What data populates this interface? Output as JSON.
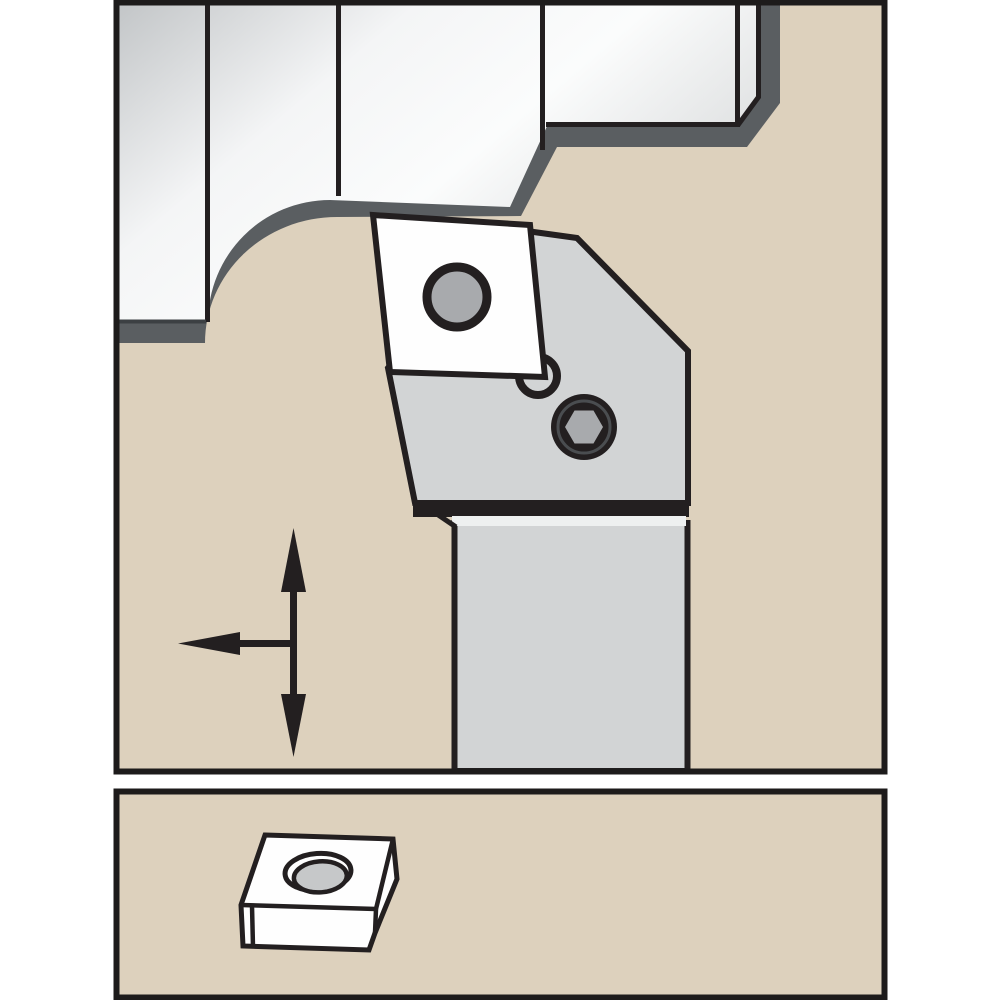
{
  "canvas": {
    "width": 1000,
    "height": 1000,
    "background": "#ffffff"
  },
  "colors": {
    "panel_background": "#ddd1bd",
    "panel_border": "#1d1b1b",
    "outline_black": "#231f20",
    "workpiece_contour_band": "#5a5e61",
    "silver_edge_dark": "#c2c5c7",
    "silver_bright": "#f4f5f6",
    "silver_highlight": "#fbfcfc",
    "silver_tail": "#d7d9da",
    "tool_body_gray": "#d2d4d5",
    "joint_highlight": "#eef0f0",
    "screw_hole_gray": "#a8aaad",
    "screw_ring_gray": "#4a4d50",
    "insert_white": "#fefefe",
    "detail_hole_gray": "#c6c8c9",
    "segment_edge_gray": "#3c4043",
    "arrow_black": "#231f20"
  },
  "components": {
    "main_view": {
      "workpiece": "machined-workpiece-profile",
      "workpiece_segments": 4,
      "toolholder": "turning-toolholder-head-and-shank",
      "insert": "indexable-insert-with-screw-hole",
      "corner_ring": "insert-corner-ring",
      "clamp_screw": "hex-socket-screw",
      "arrows": "feed-direction-arrows",
      "arrow_directions": [
        "up",
        "down",
        "left"
      ]
    },
    "detail_view": {
      "insert": "indexable-insert-3d-view",
      "hole": "center-mounting-hole"
    }
  }
}
